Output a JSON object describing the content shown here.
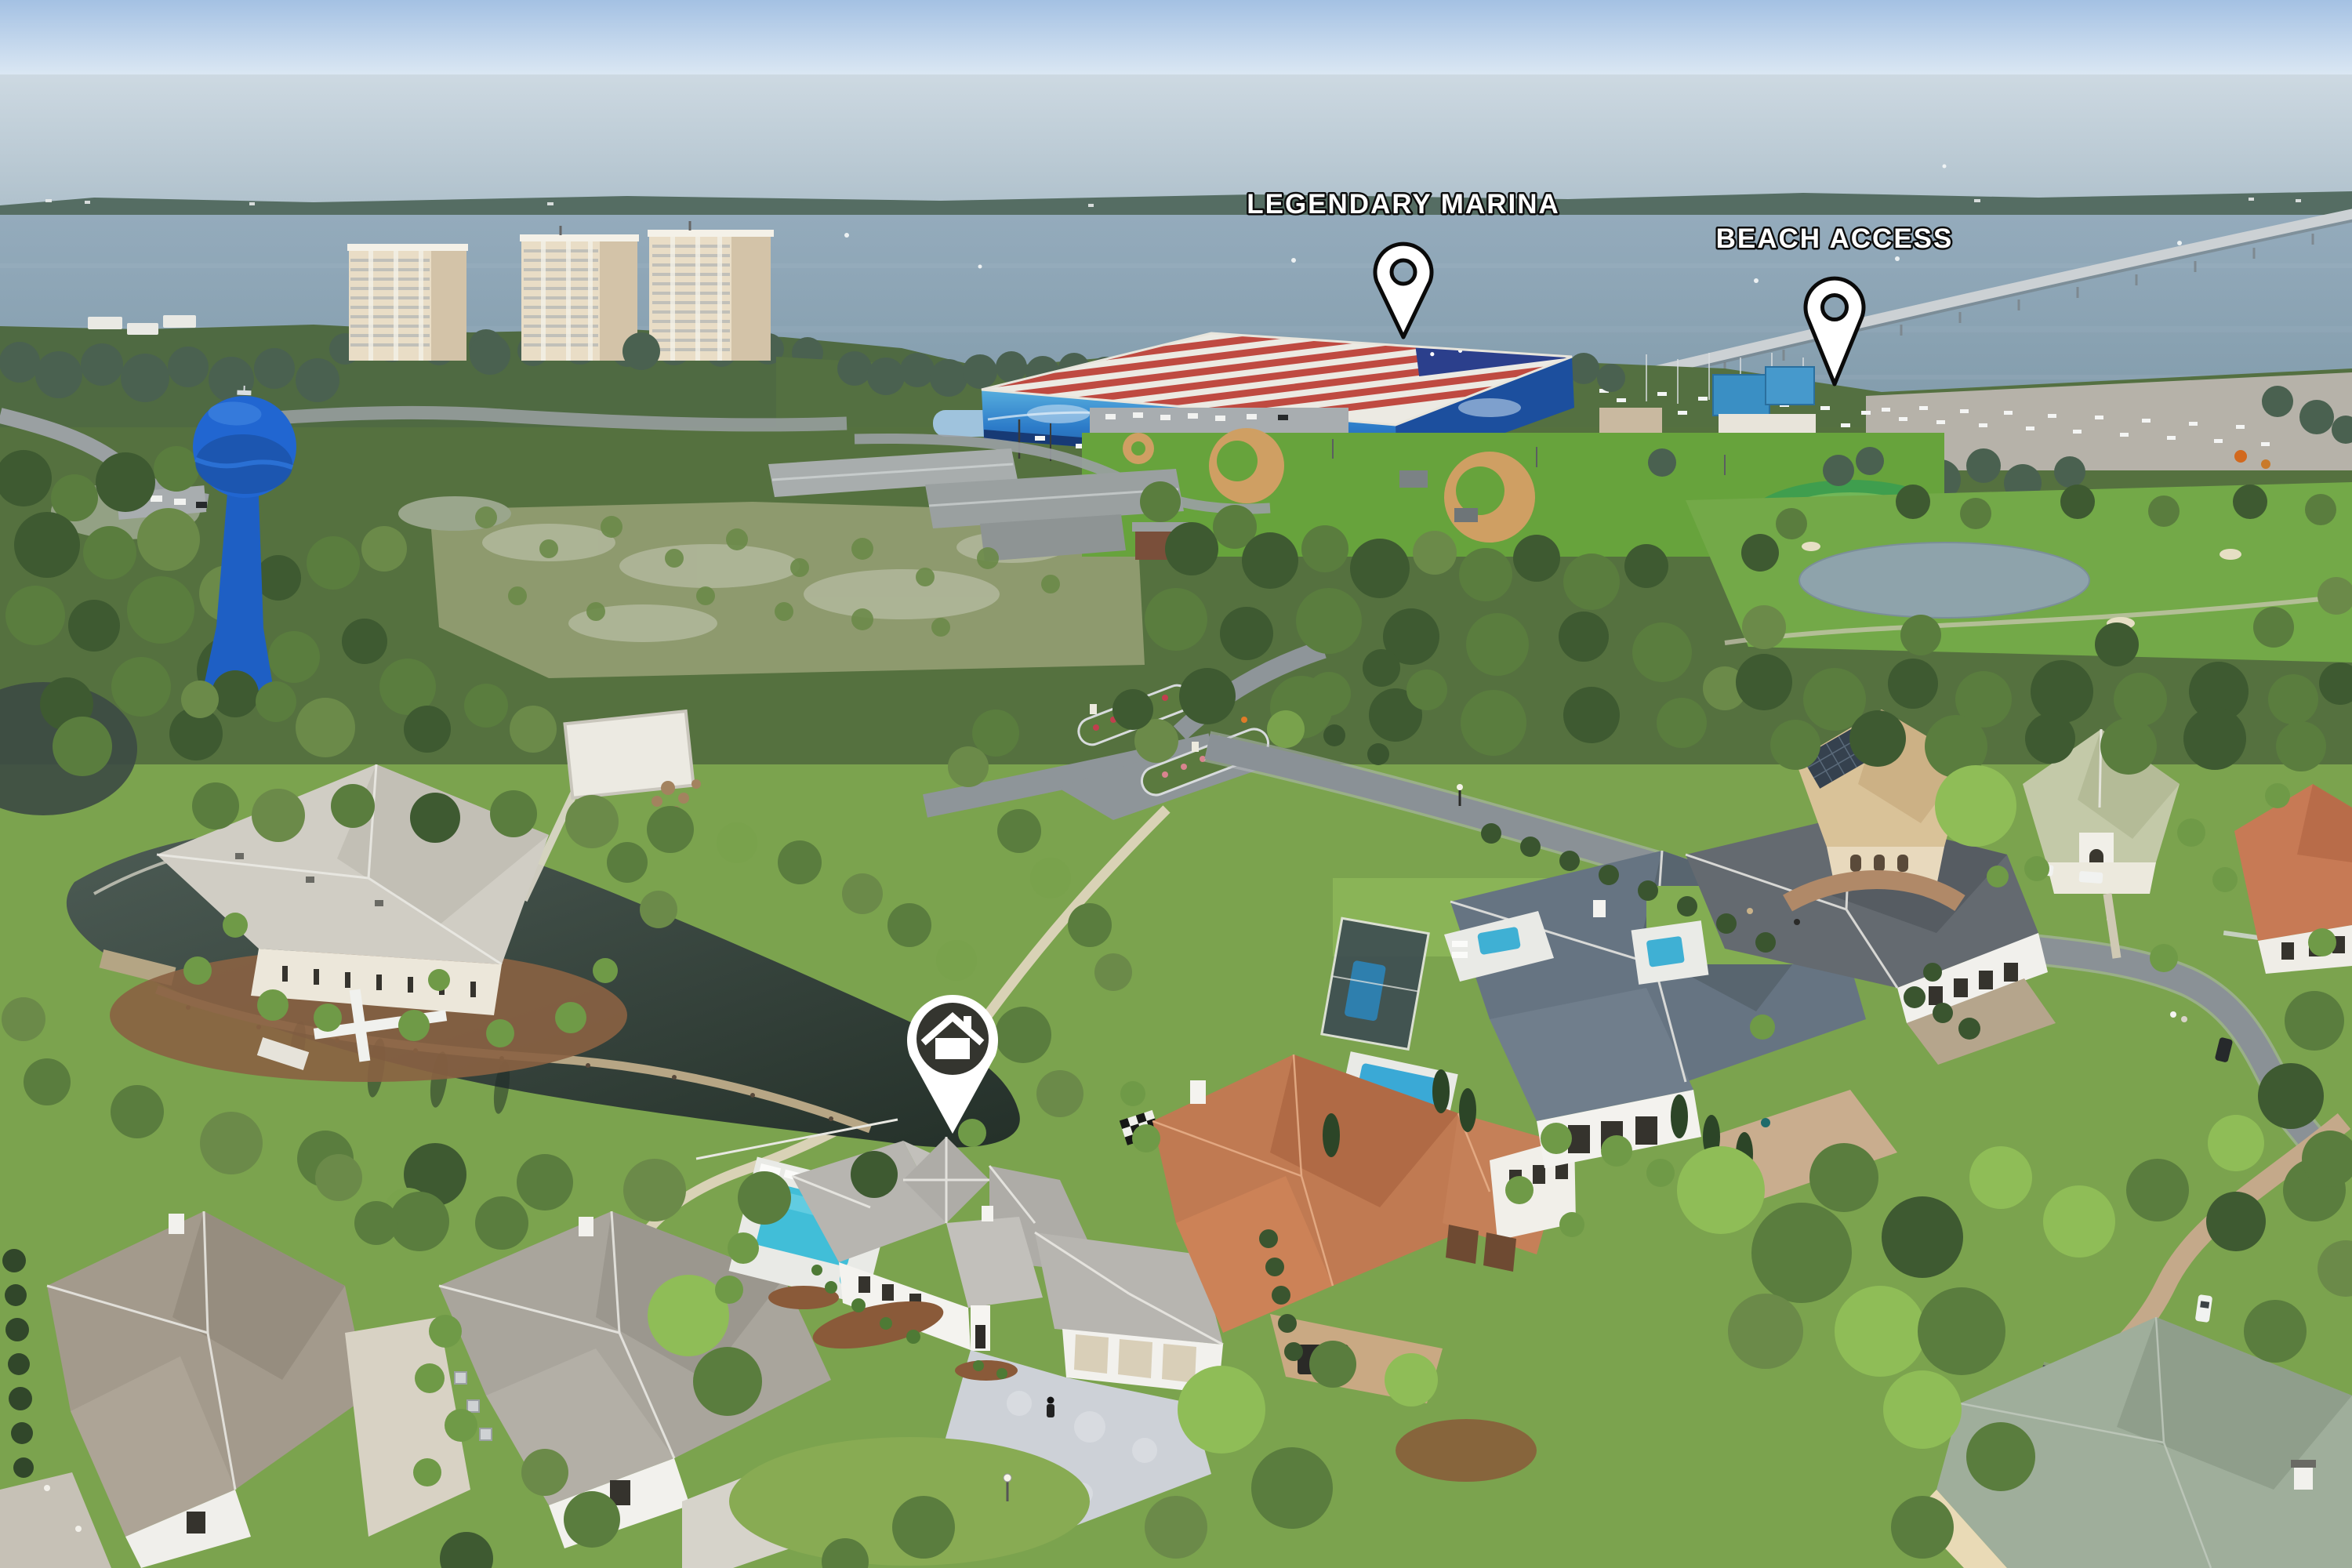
{
  "scene": {
    "type": "aerial-drone-photo",
    "subject": "waterfront-neighborhood"
  },
  "markers": {
    "marina": {
      "label": "LEGENDARY MARINA",
      "type": "location-pin"
    },
    "beach": {
      "label": "BEACH ACCESS",
      "type": "location-pin"
    },
    "home": {
      "type": "home-pin",
      "icon": "home-icon"
    }
  },
  "colors": {
    "label_text": "#ffffff",
    "label_outline": "#0d0d0d",
    "pin_fill": "#ffffff",
    "pin_outline": "#0a0a0a",
    "home_pin_disc": "#34352f",
    "water_tower_blue": "#2166d1",
    "marina_flag_red": "#bf4a41",
    "marina_flag_blue": "#2b3f8c",
    "marina_mural_blue": "#2d7cc9",
    "sky": "#aac6e6",
    "bay_water": "#8aa3b5"
  }
}
